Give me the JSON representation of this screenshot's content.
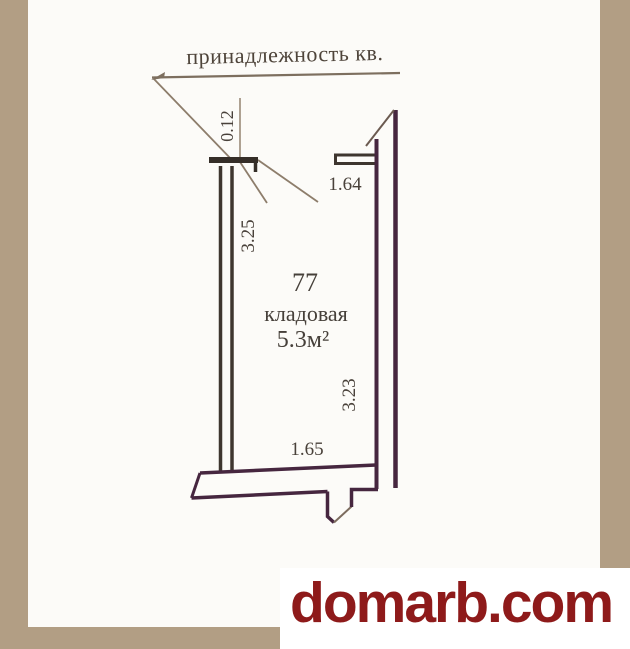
{
  "plan": {
    "title": "принадлежность кв.",
    "room": {
      "number": "77",
      "name": "кладовая",
      "area": "5.3м²"
    },
    "dimensions": {
      "wall_thickness": "0.12",
      "left_wall_length": "3.25",
      "top_opening_width": "1.64",
      "right_wall_length": "3.23",
      "bottom_wall_length": "1.65"
    },
    "colors": {
      "paper": "#fcfbf8",
      "wall_dark_brown": "#3e362f",
      "wall_maroon": "#46263f",
      "leader_line": "#8d7d6b",
      "text": "#49413a"
    }
  },
  "frame": {
    "tan_color": "#b29e84"
  },
  "watermark": {
    "text": "domarb.com",
    "color": "#8e1a1a"
  }
}
